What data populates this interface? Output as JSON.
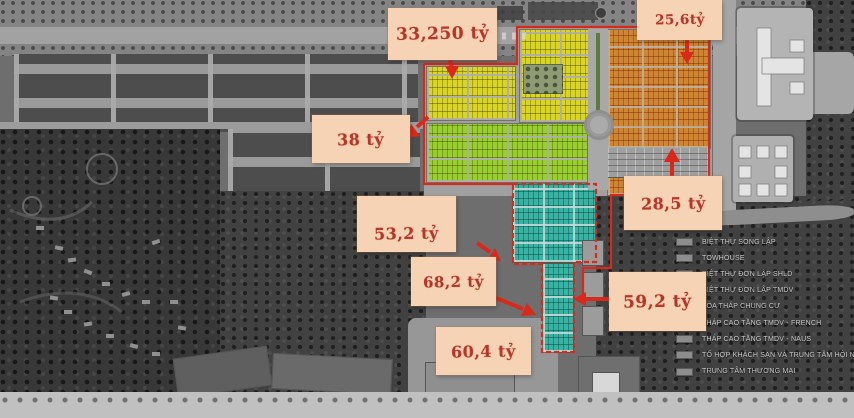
{
  "annotations": {
    "prices": [
      {
        "name": "north-yellow-block",
        "text": "33,250 tỷ"
      },
      {
        "name": "northeast-orange-block",
        "text": "25,6tỷ"
      },
      {
        "name": "west-green-block",
        "text": "38 tỷ"
      },
      {
        "name": "central-block",
        "text": "53,2 tỷ"
      },
      {
        "name": "south-central-block",
        "text": "68,2 tỷ"
      },
      {
        "name": "east-block",
        "text": "28,5 tỷ"
      },
      {
        "name": "southeast-teal-block",
        "text": "59,2 tỷ"
      },
      {
        "name": "south-teal-block",
        "text": "60,4 tỷ"
      }
    ]
  },
  "legend": {
    "swatch_color": "#8d8d8d",
    "items": [
      {
        "label": "BIỆT THỰ SONG LẬP"
      },
      {
        "label": "TOWHOUSE"
      },
      {
        "label": "BIỆT THỰ ĐƠN LẬP SHLD"
      },
      {
        "label": "BIỆT THỰ ĐƠN LẬP TMDV"
      },
      {
        "label": "TÒA THÁP CHUNG CƯ"
      },
      {
        "label": "THÁP CAO TẦNG TMDV - FRENCH"
      },
      {
        "label": "THÁP CAO TẦNG TMDV - NAUS"
      },
      {
        "label": "TỔ HỢP KHÁCH SẠN VÀ TRUNG TÂM HỘI NGHỊ"
      },
      {
        "label": "TRUNG TÂM THƯƠNG MẠI"
      }
    ]
  },
  "map": {
    "zones": [
      {
        "name": "yellow-townhouse-zone",
        "color": "#d9d426"
      },
      {
        "name": "green-townhouse-zone",
        "color": "#98cf2f"
      },
      {
        "name": "orange-townhouse-zone",
        "color": "#cd8733"
      },
      {
        "name": "teal-townhouse-zone",
        "color": "#38b2a2"
      }
    ],
    "outline_color": "#d8291c",
    "label_bg": "#f6d3b4",
    "label_text_color": "#b5372c"
  }
}
